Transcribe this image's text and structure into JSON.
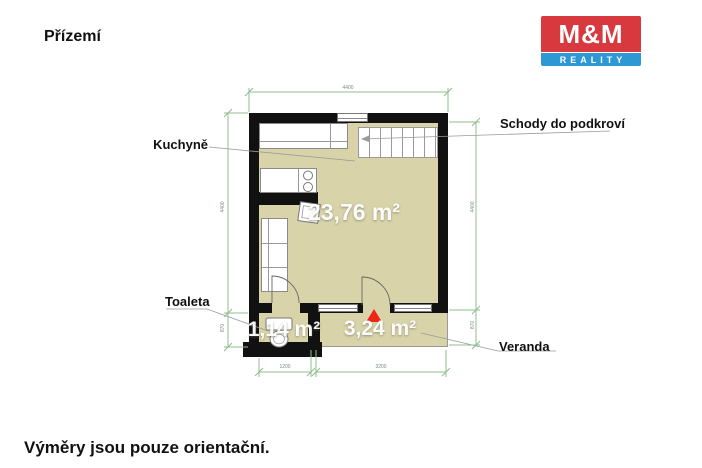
{
  "page": {
    "floor_title": "Přízemí",
    "disclaimer": "Výměry jsou pouze orientační."
  },
  "logo": {
    "brand": "M&M",
    "subtitle": "REALITY",
    "colors": {
      "red": "#d8393f",
      "blue": "#2e98d5"
    }
  },
  "plan": {
    "labels": {
      "kitchen": "Kuchyně",
      "stairs": "Schody do podkroví",
      "toilet": "Toaleta",
      "veranda": "Veranda"
    },
    "areas": {
      "main_room": "23,76 m²",
      "toilet": "1,14 m²",
      "veranda": "3,24 m²"
    },
    "dimensions": {
      "top_width": "4400",
      "left_height": "4400",
      "left_lower": "870",
      "right_height": "4400",
      "right_lower": "870",
      "bottom_left": "1200",
      "bottom_right": "3200"
    },
    "icons": {
      "entrance_marker": "red-triangle-up"
    },
    "colors": {
      "floor": "#d9d3a9",
      "wall": "#111111",
      "dimension_line": "#8fbd8f",
      "entrance_marker": "#ee2418"
    }
  }
}
